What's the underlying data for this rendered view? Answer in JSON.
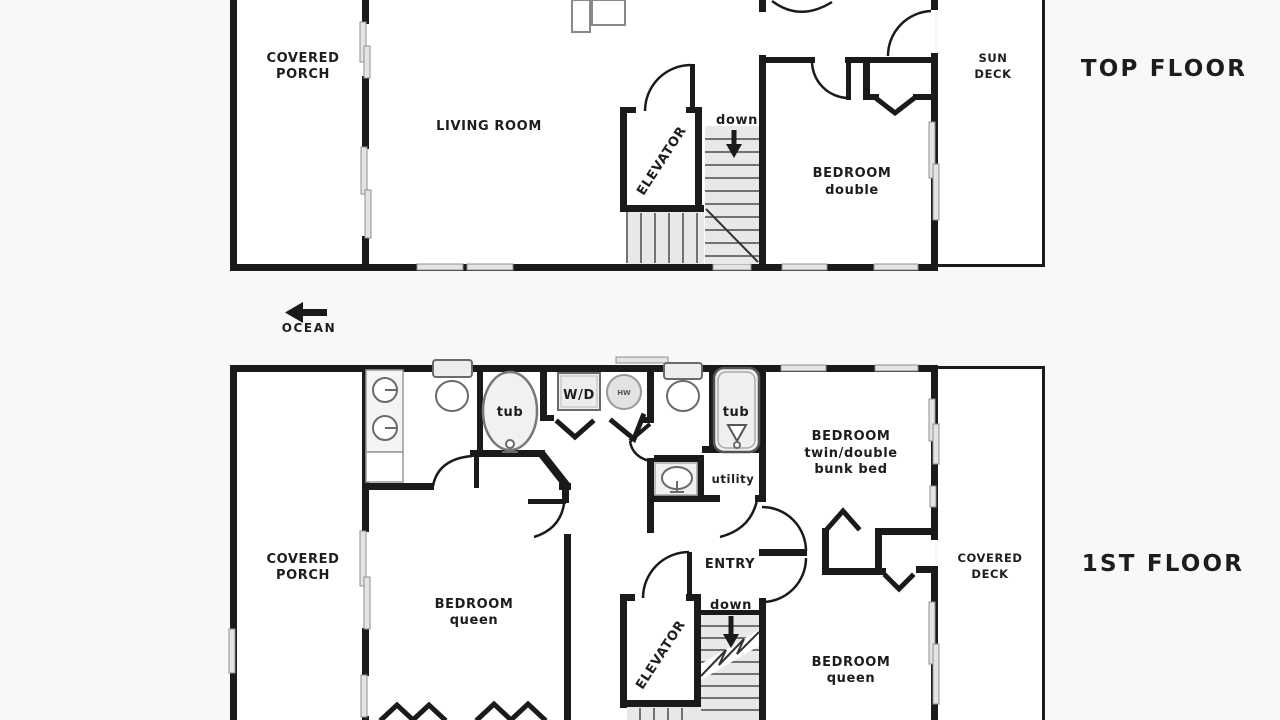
{
  "colors": {
    "wall": "#1a1a1a",
    "winfill": "#e4e4e4",
    "winstroke": "#8f8f8f",
    "fixfill": "#ededed",
    "fixstroke": "#6a6a6a",
    "stairfill": "#e8e8e8",
    "text": "#1d1d1d",
    "bg": "#f8f8f8",
    "room": "#ffffff"
  },
  "top_floor": {
    "title": "TOP FLOOR",
    "covered_porch_1": "COVERED",
    "covered_porch_2": "PORCH",
    "living_room": "LIVING ROOM",
    "elevator": "ELEVATOR",
    "down": "down",
    "bedroom_1": "BEDROOM",
    "bedroom_2": "double",
    "sun_deck_1": "SUN",
    "sun_deck_2": "DECK"
  },
  "compass": {
    "ocean": "OCEAN"
  },
  "first_floor": {
    "title": "1ST FLOOR",
    "covered_porch_1": "COVERED",
    "covered_porch_2": "PORCH",
    "tub_left": "tub",
    "wd": "W/D",
    "hw": "HW",
    "tub_right": "tub",
    "utility": "utility",
    "bedroom_bunk_1": "BEDROOM",
    "bedroom_bunk_2": "twin/double",
    "bedroom_bunk_3": "bunk bed",
    "entry": "ENTRY",
    "elevator": "ELEVATOR",
    "down": "down",
    "bedroom_queen_left_1": "BEDROOM",
    "bedroom_queen_left_2": "queen",
    "bedroom_queen_right_1": "BEDROOM",
    "bedroom_queen_right_2": "queen",
    "covered_deck_1": "COVERED",
    "covered_deck_2": "DECK"
  }
}
